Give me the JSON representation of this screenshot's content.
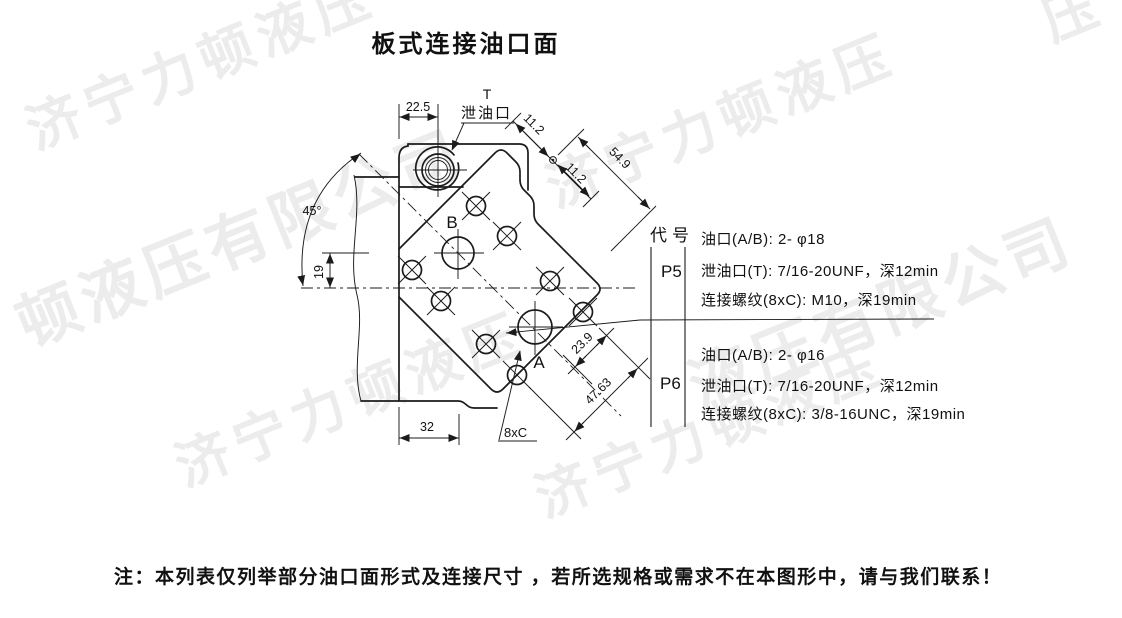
{
  "title": "板式连接油口面",
  "watermark": {
    "color": "#ececec",
    "brand": "济宁力顿液压",
    "brand_mid_left": "顿液压有限公司",
    "brand_mid_right": "液压有限公司",
    "brand_corner": "压"
  },
  "drawing": {
    "port_t_label": "T",
    "port_t_name": "泄油口",
    "port_b_label": "B",
    "port_a_label": "A",
    "bolt_pattern_label": "8xC",
    "dims": {
      "top_width": "22.5",
      "offset_1": "11.2",
      "offset_2": "11.2",
      "diag_total": "54.9",
      "angle": "45°",
      "height_offset": "19",
      "bottom_width": "32",
      "bolt_offset": "23.9",
      "bolt_diag": "47.63"
    }
  },
  "table": {
    "header": "代号",
    "rows": [
      {
        "code": "P5",
        "specs": [
          "油口(A/B): 2- φ18",
          "泄油口(T): 7/16-20UNF，深12min",
          "连接螺纹(8xC): M10，深19min"
        ]
      },
      {
        "code": "P6",
        "specs": [
          "油口(A/B): 2- φ16",
          "泄油口(T): 7/16-20UNF，深12min",
          "连接螺纹(8xC): 3/8-16UNC，深19min"
        ]
      }
    ]
  },
  "note": "注：本列表仅列举部分油口面形式及连接尺寸 ，若所选规格或需求不在本图形中，请与我们联系！"
}
